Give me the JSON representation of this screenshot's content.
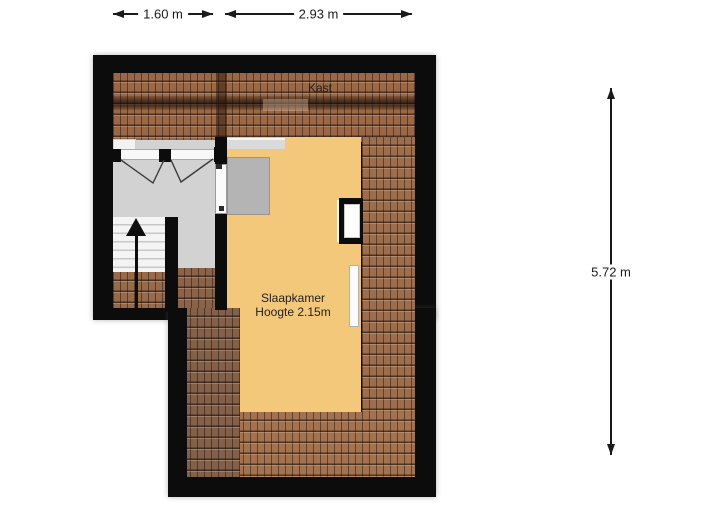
{
  "plan": {
    "type": "attic-floor-plan",
    "labels": {
      "kast": "Kast",
      "room": "Slaapkamer",
      "room_height": "Hoogte 2.15m"
    },
    "dimensions": {
      "top_left_width": "1.60 m",
      "top_right_width": "2.93 m",
      "right_height": "5.72 m"
    },
    "colors": {
      "wall": "#0c0c0c",
      "roof_tiles": "#9b6847",
      "bedroom_floor": "#f4c87a",
      "landing_floor": "#d2d2d2",
      "stair_treads": "#f4f4f4",
      "dormer": "#b4b4b4",
      "dimension_text": "#1a1a1a"
    }
  }
}
